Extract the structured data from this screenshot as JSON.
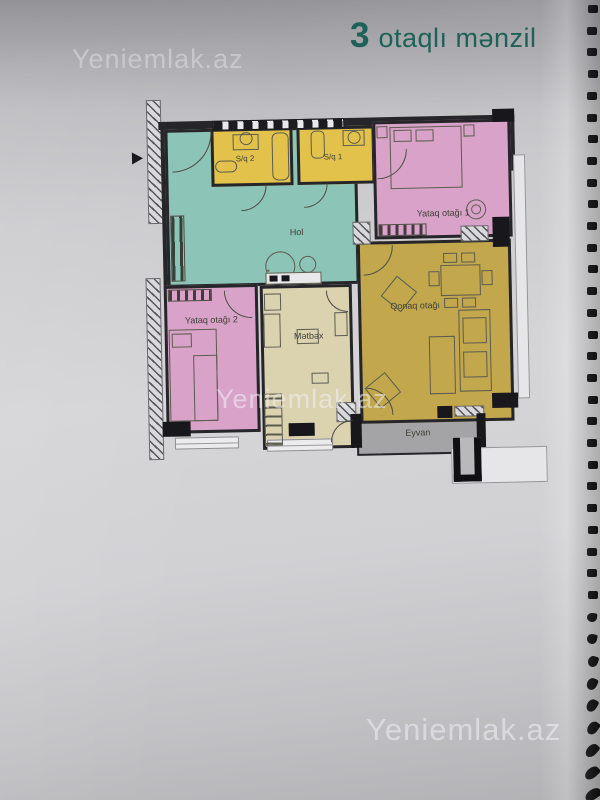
{
  "page": {
    "title": {
      "number": "3",
      "text": "otaqlı mənzil"
    },
    "watermark": "Yeniemlak.az"
  },
  "plan": {
    "rooms": [
      {
        "id": "hall",
        "label": "Hol",
        "color": "#8cc4b8"
      },
      {
        "id": "bath2",
        "label": "S/q 2",
        "color": "#e3c24c"
      },
      {
        "id": "bath1",
        "label": "S/q 1",
        "color": "#e3c24c"
      },
      {
        "id": "bedroom1",
        "label": "Yataq otağı 1",
        "color": "#d9a2c9"
      },
      {
        "id": "living",
        "label": "Qonaq otağı",
        "color": "#c2a74d"
      },
      {
        "id": "bedroom2",
        "label": "Yataq otağı 2",
        "color": "#d9a2c9"
      },
      {
        "id": "kitchen",
        "label": "Mətbəx",
        "color": "#dbd2b0"
      },
      {
        "id": "balcony",
        "label": "Eyvan",
        "color": "#a4a4a7"
      }
    ]
  },
  "colors": {
    "title": "#1d6158",
    "walls": "#26262a"
  }
}
